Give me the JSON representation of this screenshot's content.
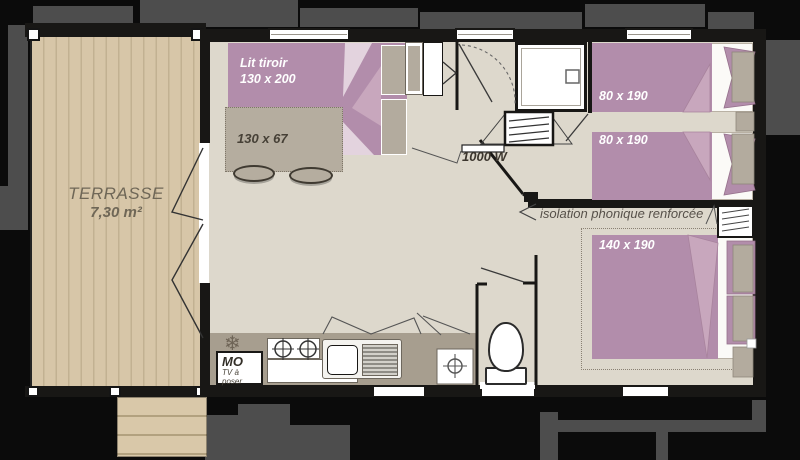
{
  "floor_plan": {
    "terrace": {
      "name": "TERRASSE",
      "area": "7,30 m²"
    },
    "living_room": {
      "sofa_bed": {
        "name": "Lit tiroir",
        "size": "130 x 200"
      },
      "table": {
        "size": "130 x 67"
      },
      "kitchen": {
        "microwave": "MO",
        "tv_note": "TV à poser",
        "fridge_icon": "❄"
      }
    },
    "bathroom": {
      "radiator_power": "1000 W"
    },
    "twin_bedroom": {
      "bed_1_size": "80 x 190",
      "bed_2_size": "80 x 190"
    },
    "master_bedroom": {
      "bed_size": "140 x 190",
      "insulation_note": "isolation phonique renforcée"
    }
  },
  "colors": {
    "background": "#0b0b0b",
    "shadow": "#4d4d4d",
    "wall": "#181715",
    "floor": "#ddd8cc",
    "terrace_wood": "#d7c6a8",
    "bed_pink": "#b28dab",
    "bed_pink_light": "#c8a7bd",
    "furniture_taupe": "#b5ad9f",
    "counter_taupe": "#a79e8f",
    "label_white": "#ffffff",
    "label_dark": "#464036"
  }
}
